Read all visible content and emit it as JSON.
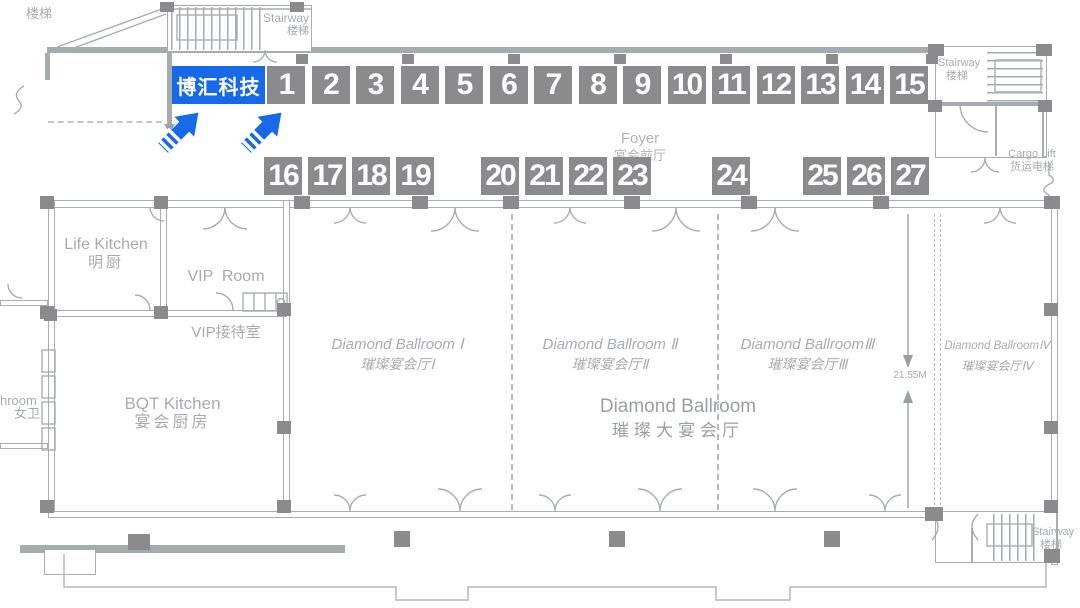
{
  "highlight": {
    "label": "博汇科技"
  },
  "booths_row1": [
    "1",
    "2",
    "3",
    "4",
    "5",
    "6",
    "7",
    "8",
    "9",
    "10",
    "11",
    "12",
    "13",
    "14",
    "15"
  ],
  "booth_groups_row2": [
    [
      "16",
      "17",
      "18",
      "19"
    ],
    [
      "20",
      "21",
      "22",
      "23"
    ],
    [
      "24"
    ],
    [
      "25",
      "26",
      "27"
    ]
  ],
  "labels": {
    "stairs_top_left": "楼梯",
    "stairway": {
      "en": "Stairway",
      "zh": "楼梯"
    },
    "cargo_lift": {
      "en": "Cargo Lift",
      "zh": "货运电梯"
    },
    "foyer": {
      "en": "Foyer",
      "zh": "宴会前厅"
    },
    "life_kitchen": {
      "en": "Life Kitchen",
      "zh": "明厨"
    },
    "vip_room": {
      "en": "VIP  Room",
      "zh": "VIP接待室"
    },
    "bqt_kitchen": {
      "en": "BQT Kitchen",
      "zh": "宴会厨房"
    },
    "bathroom": {
      "en": "hroom",
      "zh": "女卫"
    },
    "ballroom_1": {
      "en": "Diamond Ballroom Ⅰ",
      "zh": "璀璨宴会厅Ⅰ"
    },
    "ballroom_2": {
      "en": "Diamond Ballroom Ⅱ",
      "zh": "璀璨宴会厅Ⅱ"
    },
    "ballroom_3": {
      "en": "Diamond BallroomⅢ",
      "zh": "璀璨宴会厅Ⅲ"
    },
    "ballroom_4": {
      "en": "Diamond BallroomⅣ",
      "zh": "璀璨宴会厅Ⅳ"
    },
    "ballroom_main": {
      "en": "Diamond Ballroom",
      "zh": "璀璨大宴会厅"
    },
    "dimension": "21.55M"
  },
  "colors": {
    "accent_blue": "#1769e8",
    "booth_gray": "#8b8b8e",
    "line_gray": "#a9adb0",
    "text_gray": "#a8abae"
  }
}
